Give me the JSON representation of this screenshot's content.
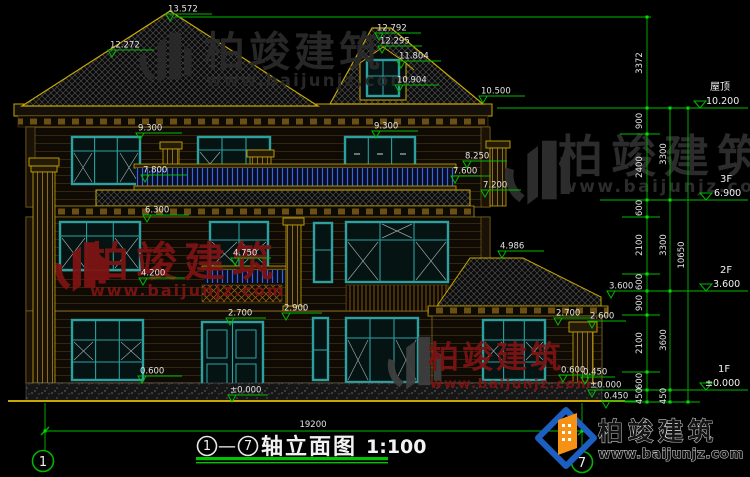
{
  "drawing": {
    "title": {
      "axis_start": "1",
      "dash": "—",
      "axis_end": "7",
      "name": "轴立面图",
      "scale": "1:100"
    },
    "axes": {
      "left": "1",
      "right": "7"
    },
    "overall_width_dim": "19200",
    "level_flags": [
      {
        "name": "屋顶",
        "value": "10.200"
      },
      {
        "name": "3F",
        "value": "6.900"
      },
      {
        "name": "2F",
        "value": "3.600"
      },
      {
        "name": "1F",
        "value": "±0.000"
      }
    ],
    "vertical_dims": {
      "attic": "3372",
      "segments": [
        "900",
        "2400",
        "600",
        "2100",
        "600",
        "900",
        "2100",
        "600",
        "450"
      ],
      "floors": [
        "3300",
        "3300",
        "3600",
        "450"
      ],
      "overall": "10650"
    },
    "spot_elevations": [
      "13.572",
      "12.272",
      "12.792",
      "12.295",
      "11.804",
      "10.904",
      "10.500",
      "9.300",
      "9.300",
      "8.250",
      "7.800",
      "7.600",
      "7.200",
      "6.300",
      "4.986",
      "4.750",
      "4.200",
      "3.600",
      "2.900",
      "2.700",
      "2.700",
      "2.600",
      "0.600",
      "0.600",
      "±0.000",
      "0.450",
      "±0.000",
      "0.450"
    ]
  },
  "watermarks": {
    "brand": "柏竣建筑",
    "url": "www.baijunjz.com"
  },
  "colors": {
    "background": "#000000",
    "dimension_green": "#00bb00",
    "linework_yellow": "#c8a800",
    "window_teal": "#2da0a0",
    "railing_blue": "#3c64d8",
    "watermark_red": "#7d1313",
    "watermark_gray": "#2c2c2c",
    "logo_blue": "#1d5fc0",
    "logo_orange": "#f59114"
  }
}
